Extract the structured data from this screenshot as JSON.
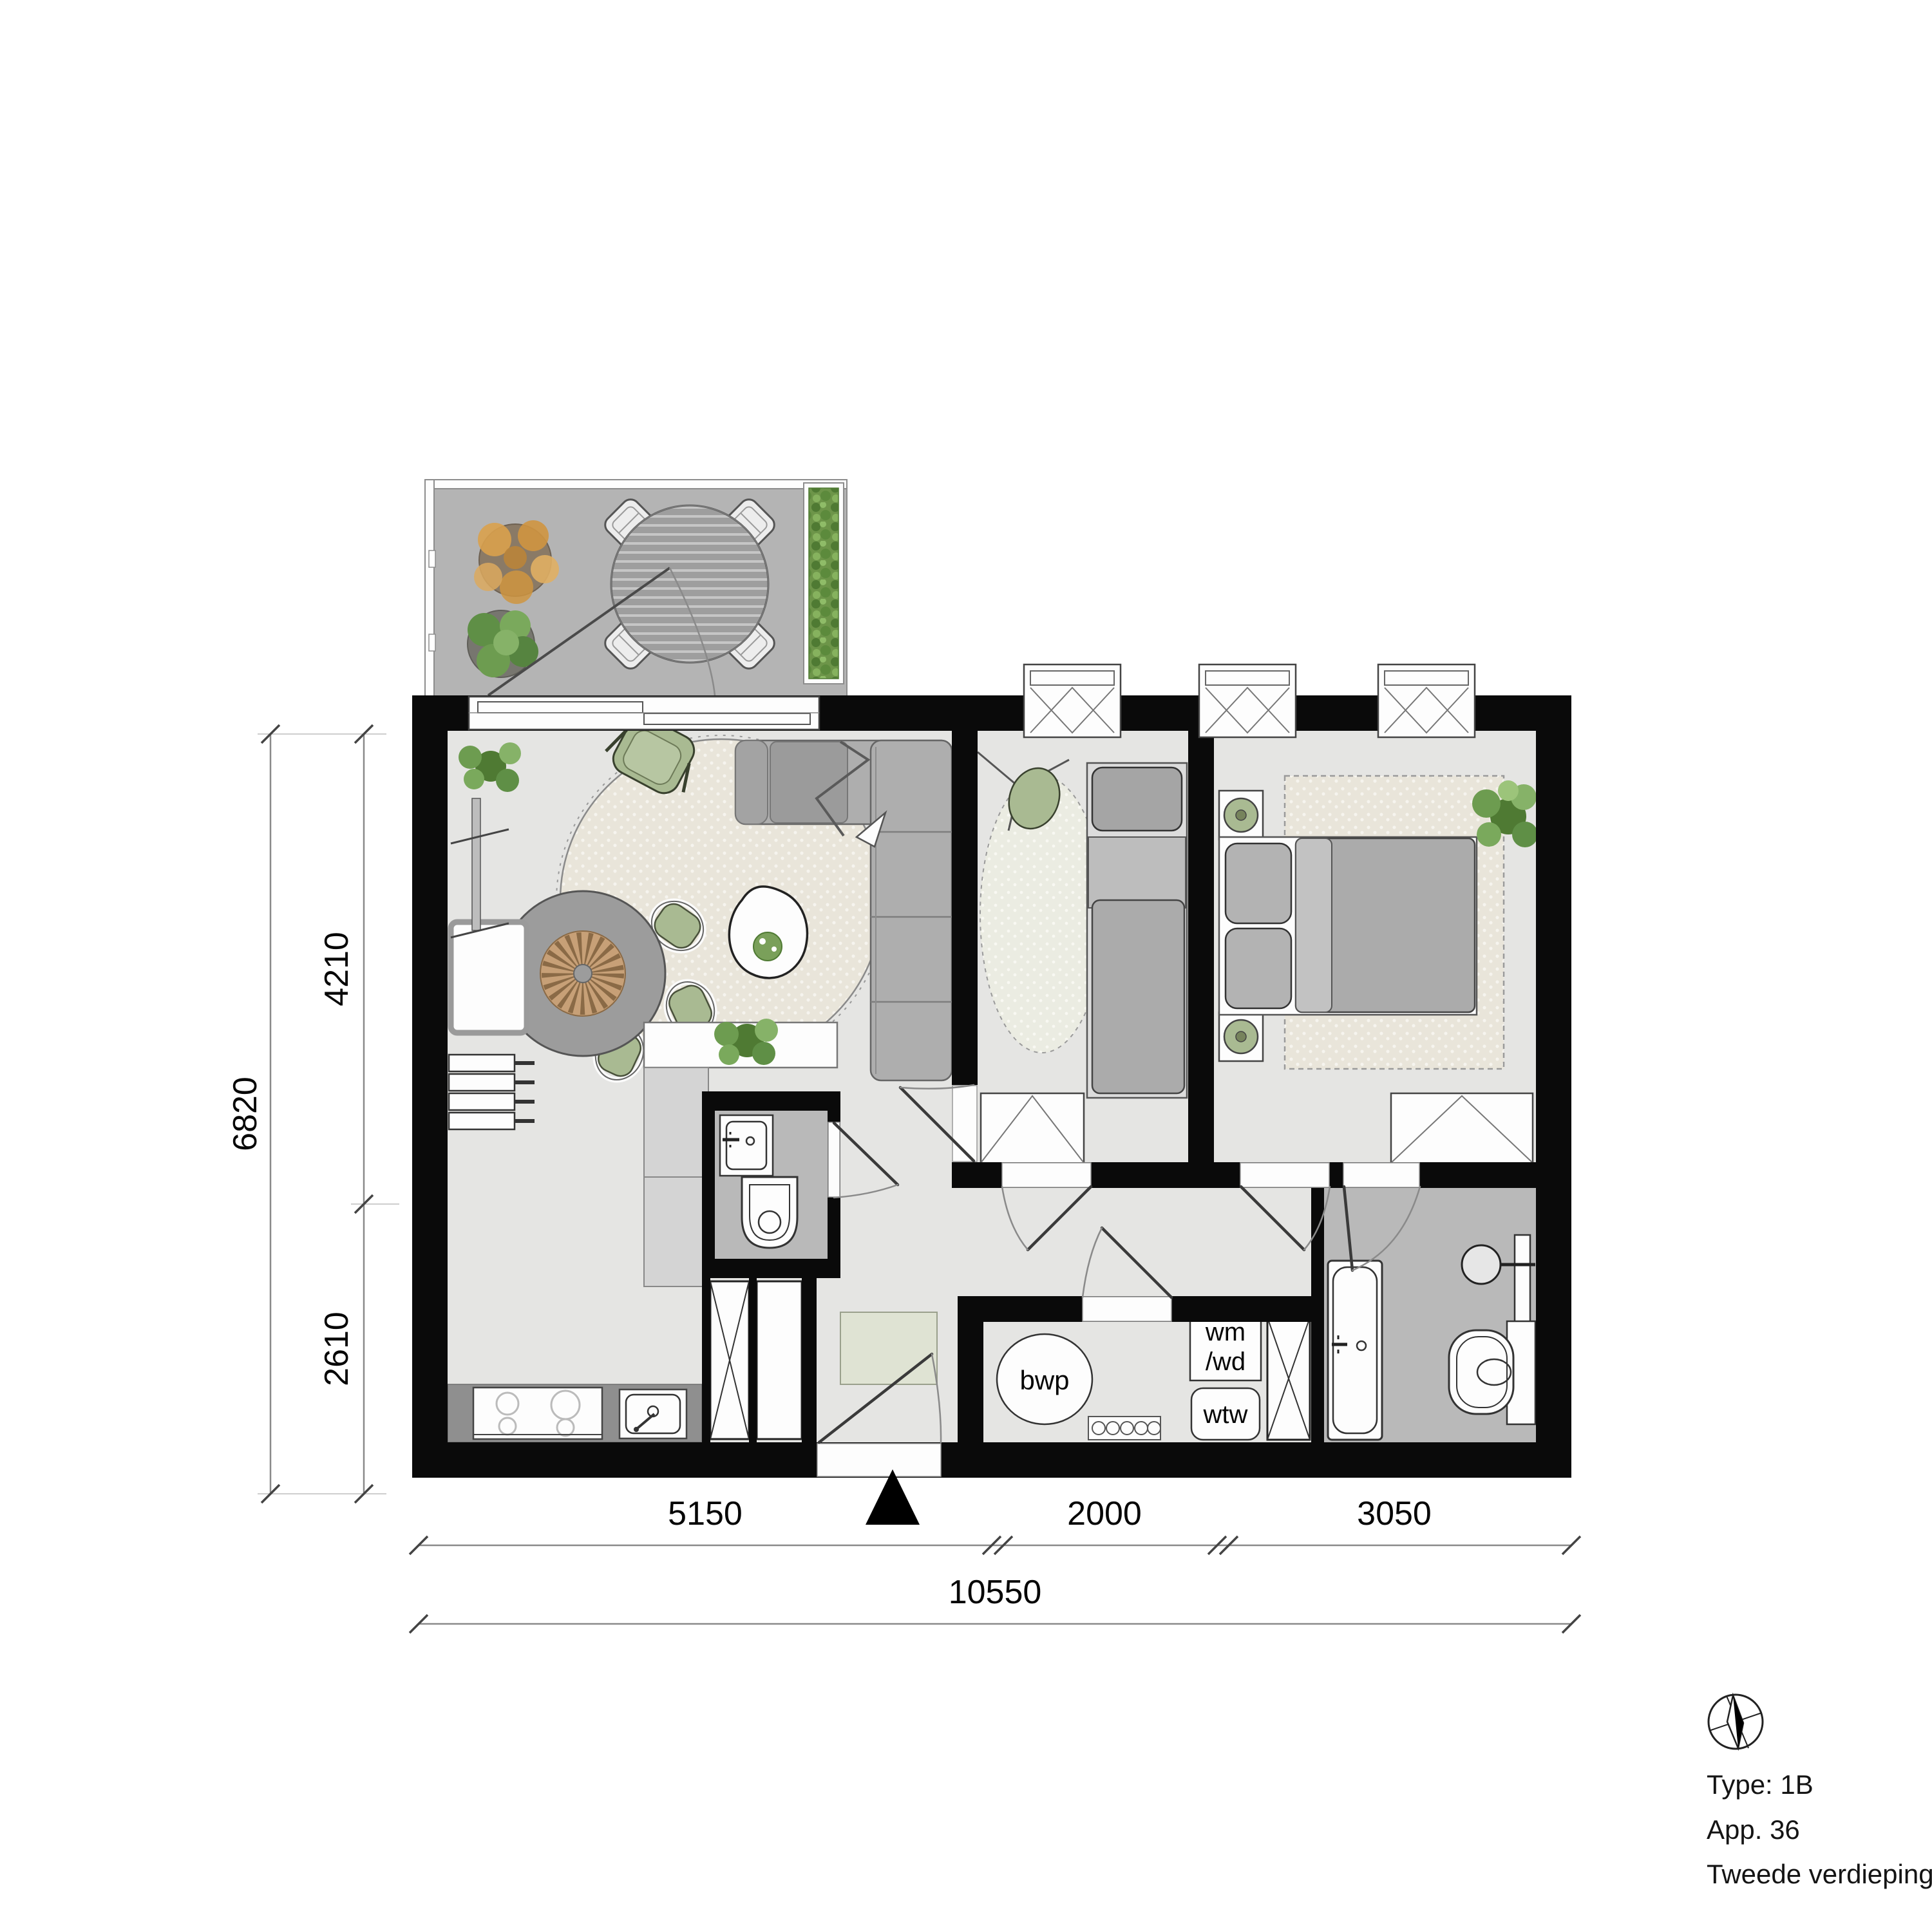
{
  "dims": {
    "left_upper": "4210",
    "left_lower": "2610",
    "left_total": "6820",
    "bottom_left": "5150",
    "bottom_middle": "2000",
    "bottom_right": "3050",
    "bottom_total": "10550"
  },
  "labels": {
    "heat_pump": "bwp",
    "washer_line1": "wm",
    "washer_line2": "/wd",
    "heat_recovery": "wtw"
  },
  "title": {
    "type": "Type: 1B",
    "app": "App. 36",
    "floor": "Tweede verdieping"
  },
  "icons": [
    "north-arrow-icon",
    "compass-icon"
  ],
  "colors": {
    "wall": "#0a0a0a",
    "floor": "#e5e5e3",
    "wet_floor": "#b9b9b9",
    "balcony_floor": "#b4b4b4",
    "counter": "#8f8f8f",
    "furniture_gray": "#ababab",
    "rug_beige": "#e9e5da",
    "accent_green": "#a9ba92",
    "hedge_green": "#6d9549"
  }
}
